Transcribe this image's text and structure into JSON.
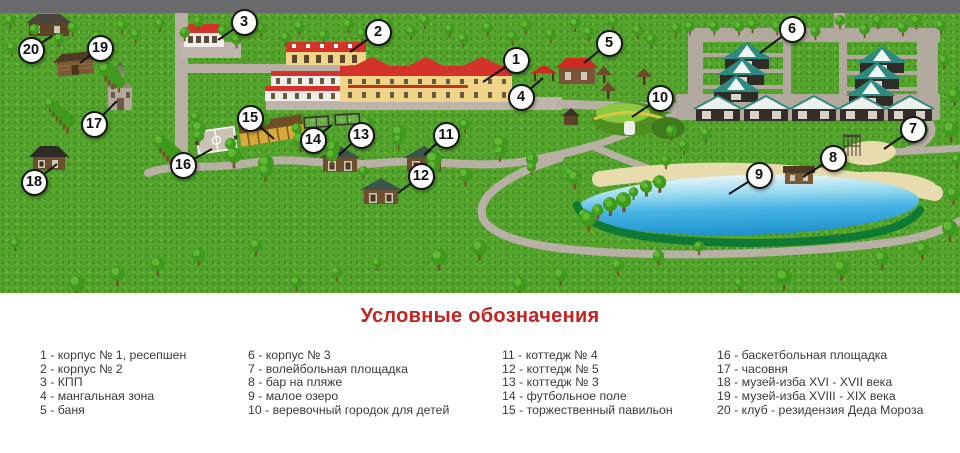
{
  "legend": {
    "title": "Условные обозначения",
    "columns": [
      [
        "1 - корпус № 1, ресепшен",
        "2 - корпус № 2",
        "3 - КПП",
        "4 - мангальная зона",
        "5 - баня"
      ],
      [
        "6 - корпус № 3",
        "7 - волейбольная площадка",
        "8 - бар на пляже",
        "9 - малое озеро",
        "10 - веревочный городок для детей"
      ],
      [
        "11 - коттедж № 4",
        "12 - коттедж № 5",
        "13 - коттедж № 3",
        "14 - футбольное поле",
        "15 - торжественный павильон"
      ],
      [
        "16 - баскетбольная площадка",
        "17 - часовня",
        "18 - музей-изба XVI - XVII века",
        "19 - музей-изба XVIII - XIX века",
        "20 - клуб - резидензия Деда Мороза"
      ]
    ]
  },
  "map": {
    "markers": [
      {
        "n": "1",
        "x": 516,
        "y": 60,
        "tx": 483,
        "ty": 82
      },
      {
        "n": "2",
        "x": 378,
        "y": 32,
        "tx": 350,
        "ty": 52
      },
      {
        "n": "3",
        "x": 244,
        "y": 22,
        "tx": 218,
        "ty": 40
      },
      {
        "n": "4",
        "x": 521,
        "y": 97,
        "tx": 543,
        "ty": 78
      },
      {
        "n": "5",
        "x": 609,
        "y": 43,
        "tx": 584,
        "ty": 63
      },
      {
        "n": "6",
        "x": 792,
        "y": 29,
        "tx": 760,
        "ty": 53
      },
      {
        "n": "7",
        "x": 913,
        "y": 129,
        "tx": 884,
        "ty": 149
      },
      {
        "n": "8",
        "x": 833,
        "y": 158,
        "tx": 803,
        "ty": 177
      },
      {
        "n": "9",
        "x": 759,
        "y": 175,
        "tx": 729,
        "ty": 194
      },
      {
        "n": "10",
        "x": 660,
        "y": 98,
        "tx": 632,
        "ty": 117
      },
      {
        "n": "11",
        "x": 446,
        "y": 135,
        "tx": 424,
        "ty": 155
      },
      {
        "n": "12",
        "x": 421,
        "y": 176,
        "tx": 398,
        "ty": 193
      },
      {
        "n": "13",
        "x": 361,
        "y": 135,
        "tx": 339,
        "ty": 155
      },
      {
        "n": "14",
        "x": 313,
        "y": 140,
        "tx": 332,
        "ty": 125
      },
      {
        "n": "15",
        "x": 250,
        "y": 118,
        "tx": 274,
        "ty": 139
      },
      {
        "n": "16",
        "x": 183,
        "y": 165,
        "tx": 212,
        "ty": 149
      },
      {
        "n": "17",
        "x": 94,
        "y": 124,
        "tx": 117,
        "ty": 101
      },
      {
        "n": "18",
        "x": 34,
        "y": 182,
        "tx": 57,
        "ty": 164
      },
      {
        "n": "19",
        "x": 100,
        "y": 48,
        "tx": 80,
        "ty": 63
      },
      {
        "n": "20",
        "x": 31,
        "y": 50,
        "tx": 52,
        "ty": 36
      }
    ]
  },
  "colors": {
    "legend_title": "#c6221e",
    "legend_text": "#3a3a3a",
    "grass": "#53a32d",
    "top_road": "#6b6b6d",
    "path": "#b8b0a5",
    "lake": "#2ba4d8",
    "lake_rim": "#0f7a33",
    "sand": "#e8dbae",
    "roof_red": "#d3332a",
    "cabin_teal": "#2c8a7e"
  }
}
